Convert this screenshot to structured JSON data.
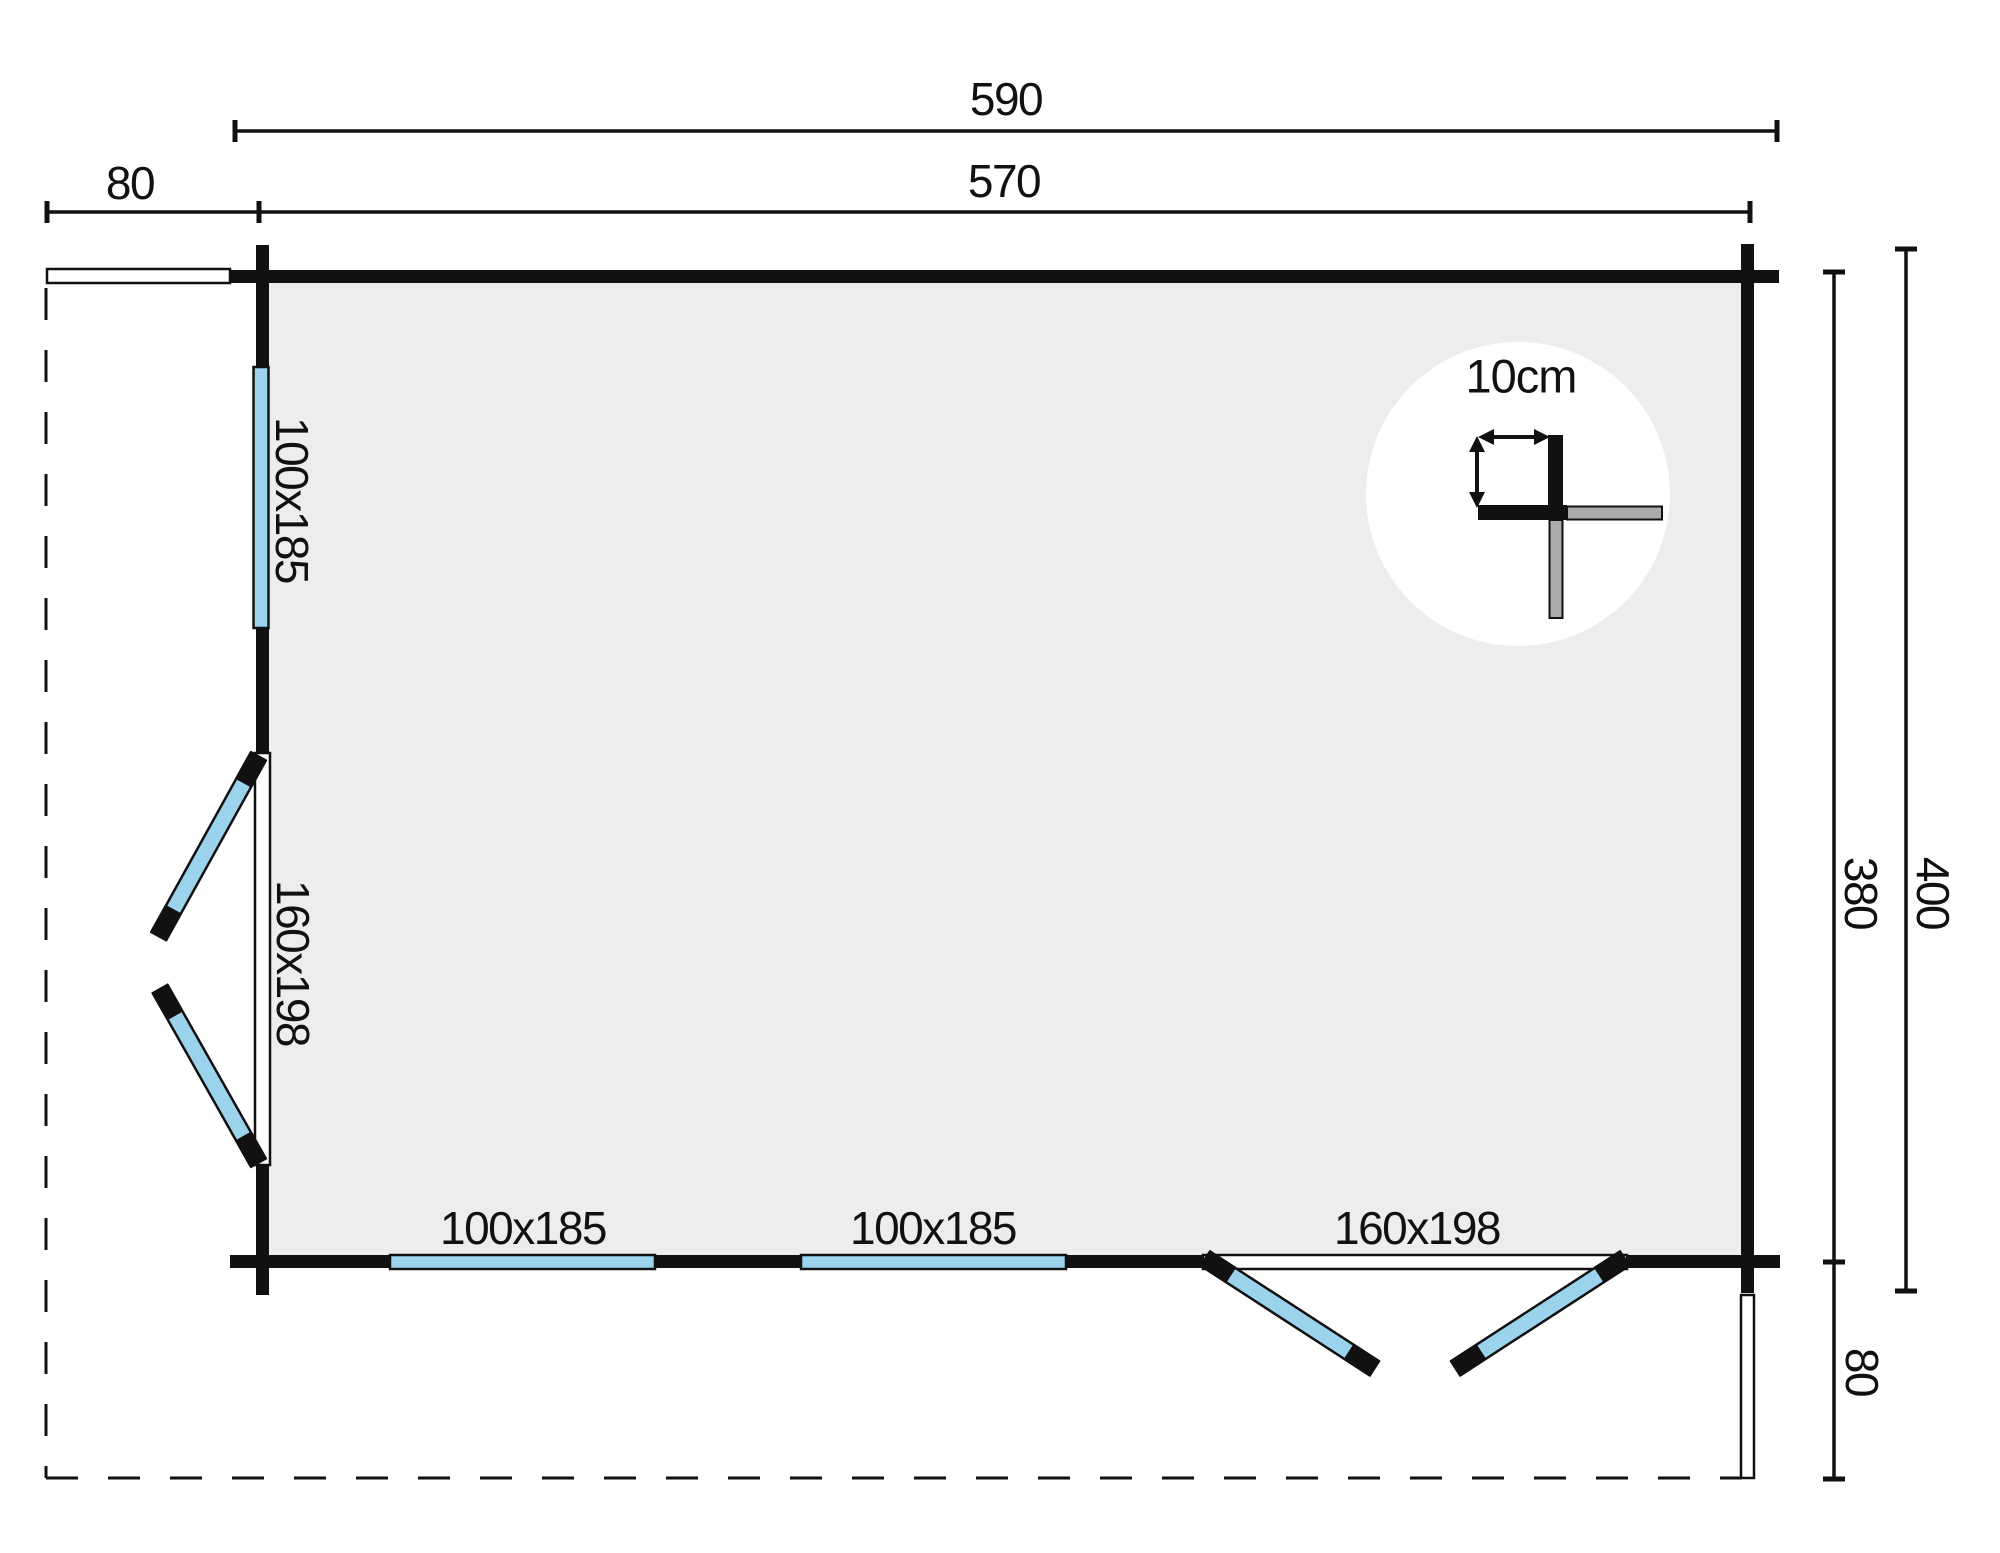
{
  "title": "Log cabin floor plan",
  "dimensions": [
    {
      "id": "overall-width",
      "value": "590"
    },
    {
      "id": "inner-width",
      "value": "570"
    },
    {
      "id": "overhang-left",
      "value": "80"
    },
    {
      "id": "inner-depth",
      "value": "380"
    },
    {
      "id": "overall-depth",
      "value": "400"
    },
    {
      "id": "overhang-bottom",
      "value": "80"
    }
  ],
  "openings": [
    {
      "id": "window-left",
      "wall": "left",
      "type": "window",
      "label": "100x185"
    },
    {
      "id": "door-left",
      "wall": "left",
      "type": "double-door",
      "label": "160x198"
    },
    {
      "id": "window-bottom-1",
      "wall": "bottom",
      "type": "window",
      "label": "100x185"
    },
    {
      "id": "window-bottom-2",
      "wall": "bottom",
      "type": "window",
      "label": "100x185"
    },
    {
      "id": "door-bottom",
      "wall": "bottom",
      "type": "double-door",
      "label": "160x198"
    }
  ],
  "detail": {
    "wall_thickness_label": "10cm"
  },
  "colors": {
    "wall": "#111111",
    "floor": "#ededee",
    "glass": "#9bd3ec",
    "log_end": "#ababab",
    "background": "#ffffff"
  }
}
